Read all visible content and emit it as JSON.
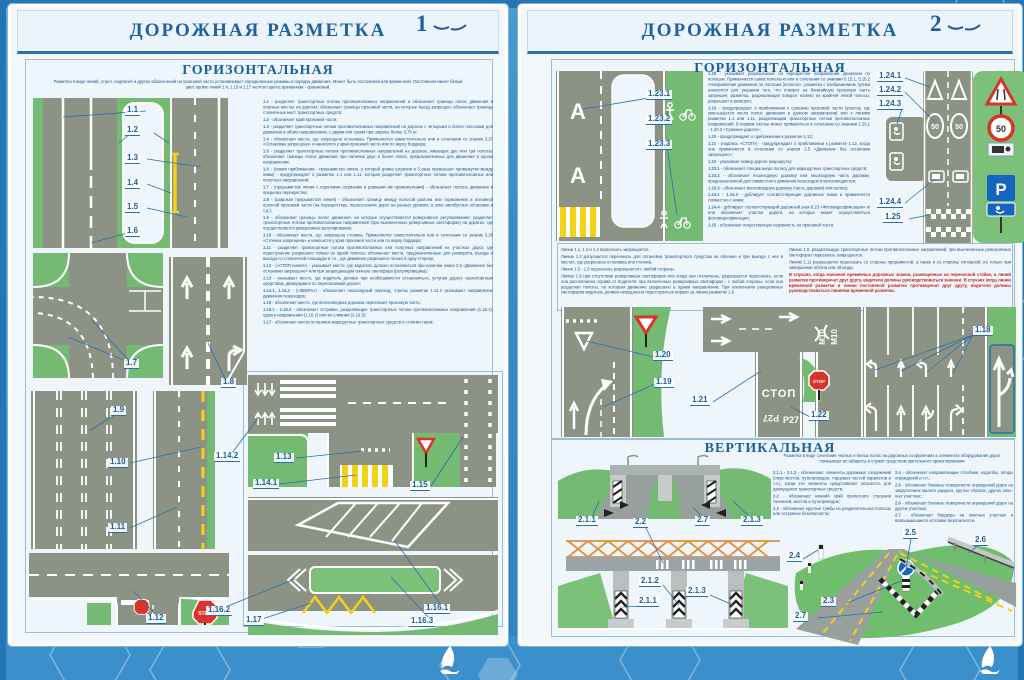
{
  "panel1": {
    "title": "ДОРОЖНАЯ РАЗМЕТКА",
    "page_num": "1",
    "section": "ГОРИЗОНТАЛЬНАЯ",
    "intro": "Разметка в виде линий, стрел, надписей и других обозначений на проезжей части устанавливает определенные режимы и порядок движения. Может быть постоянной или временной. Постоянная имеет белый цвет, кроме линий 1.4, 1.10 и 1.17 желтого цвета; временная - оранжевый.",
    "items": [
      {
        "num": "1.1",
        "text": "разделяет транспортные потоки противоположных направлений и обозначает границы полос движения в опасных местах на дорогах; обозначает границы проезжей части, на которые въезд запрещен; обозначает границы стояночных мест транспортных средств;"
      },
      {
        "num": "1.2",
        "text": "обозначает край проезжей части;"
      },
      {
        "num": "1.3",
        "text": "разделяет транспортные потоки противоположных направлений на дорогах с четырьмя и более полосами для движения в обоих направлениях, с двумя или тремя при ширине более 3,75 м;"
      },
      {
        "num": "1.4",
        "text": "обозначает места, где запрещена остановка. Применяется самостоятельно или в сочетании со знаком 3.27 «Остановка запрещена» и наносится у края проезжей части или по верху бордюра;"
      },
      {
        "num": "1.5",
        "text": "разделяет транспортные потоки противоположных направлений на дорогах, имеющих две или три полосы; обозначает границы полос движения при наличии двух и более полос, предназначенных для движения в одном направлении;"
      },
      {
        "num": "1.6",
        "text": "(линия приближения - прерывистая линия, у которой длина штрихов в 3 раза превышает промежутки между ними) - предупреждает о разметке 1.1 или 1.11, которая разделяет транспортные потоки противоположных или попутных направлений;"
      },
      {
        "num": "1.7",
        "text": "(прерывистая линия с короткими штрихами и равными им промежутками) - обозначает полосы движения в пределах перекрестка;"
      },
      {
        "num": "1.8",
        "text": "(широкая прерывистая линия) - обозначает границу между полосой разгона или торможения и основной полосой проезжей части (на перекрестках, пересечениях дорог на разных уровнях, в зоне автобусных остановок и т.д.);"
      },
      {
        "num": "1.9",
        "text": "обозначает границы полос движения, на которых осуществляется реверсивное регулирование; разделяет транспортные потоки противоположных направлений (при выключенных реверсивных светофорах) на дорогах, где осуществляется реверсивное регулирование;"
      },
      {
        "num": "1.10",
        "text": "обозначает места, где запрещена стоянка. Применяется самостоятельно или в сочетании со знаком 3.28 «Стоянка запрещена» и наносится у края проезжей части или по верху бордюра;"
      },
      {
        "num": "1.11",
        "text": "разделяет транспортные потоки противоположных или попутных направлений на участках дорог, где перестроение разрешено только из одной полосы; обозначает места, предназначенные для разворота, въезда и выезда со стояночной площадки и т.п., где движение разрешено только в одну сторону;"
      },
      {
        "num": "1.12",
        "text": "(«СТОП-линия») - указывает место, где водитель должен остановиться при наличии знака 2.5 «Движение без остановки запрещено» или при запрещающем сигнале светофора (регулировщика);"
      },
      {
        "num": "1.13",
        "text": "указывает место, где водитель должен при необходимости остановиться, уступая дорогу транспортным средствам, движущимся по пересекаемой дороге;"
      },
      {
        "num": "1.14.1, 1.14.2",
        "text": "(«ЗЕБРА») - обозначает пешеходный переход; стрелы разметки 1.14.2 указывают направление движения пешеходов;"
      },
      {
        "num": "1.15",
        "text": "обозначает место, где велосипедная дорожка пересекает проезжую часть;"
      },
      {
        "num": "1.16.1 - 1.16.3",
        "text": "обозначает островки, разделяющие транспортные потоки противоположных направлений (1.16.1), одного направления (1.16.2) или их слияния (1.16.3);"
      },
      {
        "num": "1.17",
        "text": "обозначает места остановок маршрутных транспортных средств и стоянки такси;"
      }
    ],
    "labels": [
      "1.1",
      "1.2",
      "1.3",
      "1.4",
      "1.5",
      "1.6",
      "1.7",
      "1.8",
      "1.9",
      "1.10",
      "1.11",
      "1.12",
      "1.14.2",
      "1.13",
      "1.14.1",
      "1.15",
      "1.16.2",
      "1.16.1",
      "1.16.3",
      "1.17"
    ]
  },
  "panel2": {
    "title": "ДОРОЖНАЯ РАЗМЕТКА",
    "page_num": "2",
    "section": "ГОРИЗОНТАЛЬНАЯ",
    "section2": "ВЕРТИКАЛЬНАЯ",
    "items": [
      {
        "num": "1.18",
        "text": "указывает разрешенные на перекрестке направления движения по полосам. Применяется самостоятельно или в сочетании со знаками 5.15.1, 5.15.2 «Направления движения по полосам (полосе)»; разметка с изображением тупика наносится для указания того, что поворот на ближайшую проезжую часть запрещен; разметка, разрешающая поворот налево из крайней левой полосы, разрешает и разворот;"
      },
      {
        "num": "1.19",
        "text": "предупреждает о приближении к сужению проезжей части (участку, где уменьшается число полос движения в данном направлении) или к линиям разметки 1.1 или 1.11, разделяющим транспортные потоки противоположных направлений. В первом случае может применяться в сочетании со знаками 1.20.1 - 1.20.3 «Сужение дороги»;"
      },
      {
        "num": "1.20",
        "text": "предупреждает о приближении к разметке 1.13;"
      },
      {
        "num": "1.21",
        "text": "(надпись «СТОП») - предупреждает о приближении к разметке 1.12, когда она применяется в сочетании со знаком 2.5 «Движение без остановки запрещено»;"
      },
      {
        "num": "1.22",
        "text": "указывает номер дороги (маршрута);"
      },
      {
        "num": "1.23.1",
        "text": "обозначает специальную полосу для маршрутных транспортных средств;"
      },
      {
        "num": "1.23.2",
        "text": "обозначает пешеходную дорожку или пешеходную часть дорожки, предназначенной для совместного движения пешеходов и велосипедистов;"
      },
      {
        "num": "1.23.3",
        "text": "обозначает велосипедную дорожку (часть дорожки) или полосу;"
      },
      {
        "num": "1.24.1 - 1.24.3",
        "text": "дублирует соответствующие дорожные знаки и применяется совместно с ними;"
      },
      {
        "num": "1.24.4",
        "text": "дублирует соответствующий дорожный знак 8.23 «Фотовидеофиксация» и/или обозначает участки дороги, на которых может осуществляться фотовидеофиксация;"
      },
      {
        "num": "1.25",
        "text": "обозначает искусственную неровность на проезжей части."
      }
    ],
    "notes_left": [
      "Линии 1.1, 1.2 и 1.3 пересекать запрещается.",
      "Линию 1.2 допускается пересекать для остановки транспортного средства на обочине и при выезде с нее в местах, где разрешена остановка или стоянка.",
      "Линии 1.5 - 1.8 пересекать разрешается с любой стороны.",
      "Линию 1.9 при отсутствии реверсивных светофоров или когда они отключены, разрешается пересекать, если она расположена справа от водителя; при включенных реверсивных светофорах - с любой стороны, если она разделяет полосы, по которым движение разрешено в одном направлении. При отключении реверсивных светофоров водитель должен немедленно перестроиться вправо за линию разметки 1.9."
    ],
    "notes_right": [
      "Линию 1.9, разделяющую транспортные потоки противоположных направлений, при выключенных реверсивных светофорах пересекать запрещается.",
      "Линию 1.11 разрешается пересекать со стороны прерывистой, а также и со стороны сплошной, но только при завершении обгона или объезда."
    ],
    "notes_red": "В случаях, когда значения временных дорожных знаков, размещенных на переносной стойке, и линий разметки противоречат друг другу, водители должны руководствоваться знаками. В случаях когда линии временной разметки и линии постоянной разметки противоречат друг другу, водители должны руководствоваться линиями временной разметки.",
    "vertical_intro": "Разметка в виде сочетания черных и белых полос на дорожных сооружениях и элементах оборудования дорог показывает их габариты и служит средством зрительного ориентирования",
    "vertical_left": [
      {
        "num": "2.1.1 - 2.1.3",
        "text": "обозначают элементы дорожных сооружений (опор мостов, путепроводов, торцевых частей парапетов и т.п.), когда эти элементы представляют опасность для движущихся транспортных средств;"
      },
      {
        "num": "2.2",
        "text": "обозначает нижний край пролетного строения тоннелей, мостов и путепроводов;"
      },
      {
        "num": "2.3",
        "text": "обозначает круглые тумбы на разделительных полосах или островках безопасности;"
      }
    ],
    "vertical_right": [
      {
        "num": "2.4",
        "text": "обозначает направляющие столбики, надолбы, опоры ограждений и т.п.;"
      },
      {
        "num": "2.5",
        "text": "обозначает боковые поверхности ограждений дорог на закруглениях малого радиуса, крутых спусках, других опас­ных участках;"
      },
      {
        "num": "2.6",
        "text": "обозначает боковые поверхности ограждений дорог на других участках;"
      },
      {
        "num": "2.7",
        "text": "обозначает бордюры на опасных участках и возвышающиеся островки безопасности."
      }
    ],
    "labels": [
      "1.23.1",
      "1.23.2",
      "1.23.3",
      "1.24.1",
      "1.24.2",
      "1.24.3",
      "1.24.4",
      "1.25",
      "1.20",
      "1.19",
      "1.21",
      "1.22",
      "1.18",
      "2.1.1",
      "2.2",
      "2.7",
      "2.1.3",
      "2.1.2",
      "2.1.1",
      "2.1.3",
      "2.4",
      "2.5",
      "2.6",
      "2.3",
      "2.7"
    ]
  },
  "roadtexts": {
    "bus_lane": "А",
    "stop_marking": "СТОП",
    "route_p27": "Р27",
    "route_m10": "М10",
    "stop_sign": "STOP",
    "speed_50": "50",
    "parking": "P"
  },
  "colors": {
    "accent_blue": "#1d5c9e",
    "road": "#8d9384",
    "grass": "#74ba72",
    "yellow": "#f2d216",
    "sign_red": "#d8342c",
    "sign_blue": "#1565c0",
    "red_text": "#c2271f"
  }
}
